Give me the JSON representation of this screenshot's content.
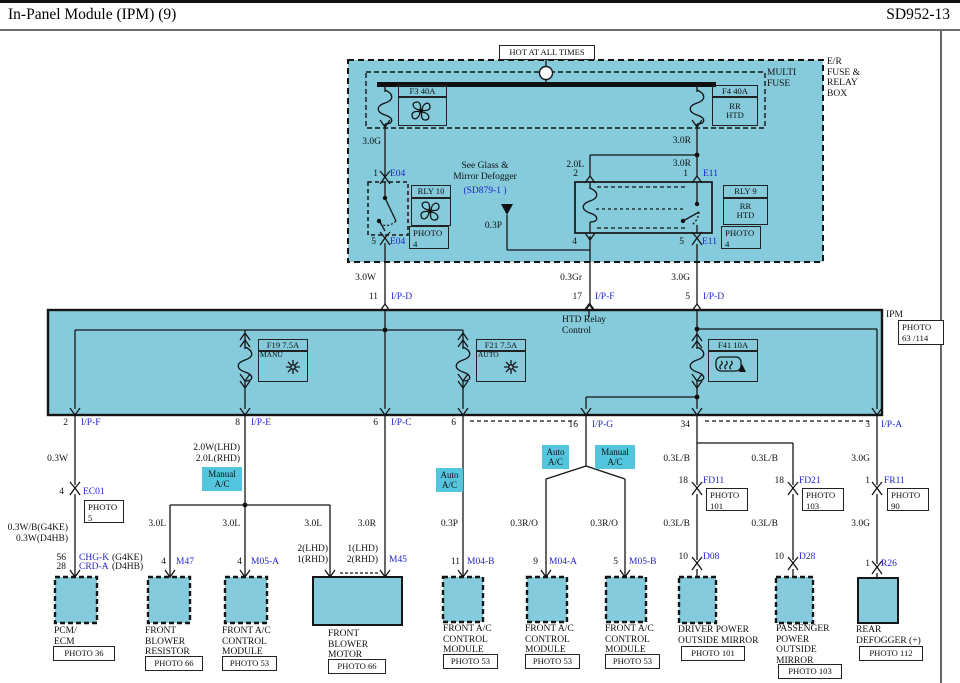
{
  "header": {
    "title": "In-Panel Module (IPM) (9)",
    "code": "SD952-13"
  },
  "colors": {
    "panel_fill": "#85cbdc",
    "highlight_fill": "#53c6de",
    "link_blue": "#1f1fd0"
  },
  "power": {
    "hot_label": "HOT AT ALL TIMES",
    "er_box_label": "E/R\nFUSE &\nRELAY\nBOX",
    "multi_fuse_label": "MULTI\nFUSE",
    "f3_label": "F3 40A",
    "f4_label": "F4 40A",
    "f4_sub": "RR\nHTD",
    "w_f3_out": "3.0G",
    "w_f4_out": "3.0R",
    "w_coil_in": "2.0L",
    "w_sw_in": "3.0R",
    "rly10": {
      "label": "RLY 10",
      "photo": "PHOTO\n4",
      "pin_top": "1",
      "conn_top": "E04",
      "pin_bot": "5",
      "conn_bot": "E04"
    },
    "rly9": {
      "label": "RLY 9",
      "sub": "RR\nHTD",
      "photo": "PHOTO\n4",
      "pin_coil_top": "2",
      "pin_coil_bot": "4",
      "pin_sw_top": "1",
      "conn_sw_top": "E11",
      "pin_sw_bot": "5",
      "conn_sw_bot": "E11"
    },
    "see_glass": "See Glass &\nMirror Defogger",
    "sd_ref": "(SD879-1 )",
    "w_defog_ctl": "0.3P",
    "w_out_left": "3.0W",
    "w_out_mid": "0.3Gr",
    "w_out_right": "3.0G"
  },
  "ipm": {
    "label": "IPM",
    "photo": "PHOTO\n63 /114",
    "htd_note": "HTD Relay\nControl",
    "f19_label": "F19 7.5A",
    "f19_sub": "MANU",
    "f21_label": "F21 7.5A",
    "f21_sub": "AUTO",
    "f41_label": "F41 10A",
    "pins_top": [
      {
        "num": "11",
        "name": "I/P-D"
      },
      {
        "num": "17",
        "name": "I/P-F"
      },
      {
        "num": "5",
        "name": "I/P-D"
      }
    ],
    "pins_bottom": [
      {
        "num": "2",
        "name": "I/P-F"
      },
      {
        "num": "8",
        "name": "I/P-E"
      },
      {
        "num": "6",
        "name": "I/P-C"
      },
      {
        "num": "6",
        "name": ""
      },
      {
        "num": "16",
        "name": "I/P-G"
      },
      {
        "num": "34",
        "name": ""
      },
      {
        "num": "3",
        "name": "I/P-A"
      }
    ]
  },
  "branches": {
    "pcm": {
      "w1": "0.3W",
      "pin": "4",
      "conn": "EC01",
      "photo": "PHOTO\n5",
      "w2": "0.3W/B(G4KE)\n0.3W(D4HB)",
      "pin1": "56",
      "name1": "CHG-K",
      "var1": "(G4KE)",
      "pin2": "28",
      "name2": "CRD-A",
      "var2": "(D4HB)"
    },
    "manual": {
      "w1": "2.0W(LHD)\n2.0L(RHD)",
      "tag": "Manual\nA/C",
      "w2": "3.0L",
      "w3": "3.0L",
      "w4": "3.0L",
      "pin_m47": "4",
      "conn_m47": "M47",
      "pin_m05a": "4",
      "conn_m05a": "M05-A",
      "motor_pin_l": "2(LHD)\n1(RHD)"
    },
    "motor": {
      "w1": "3.0R",
      "pin": "1(LHD)\n2(RHD)",
      "conn": "M45"
    },
    "auto": {
      "tag": "Auto\nA/C",
      "w1": "0.3P",
      "pin": "11",
      "conn": "M04-B"
    },
    "indicator": {
      "tag_l": "Auto\nA/C",
      "tag_r": "Manual\nA/C",
      "w_l": "0.3R/O",
      "w_r": "0.3R/O",
      "pin_l": "9",
      "conn_l": "M04-A",
      "pin_r": "5",
      "conn_r": "M05-B"
    },
    "mirror_l": {
      "w1": "0.3L/B",
      "pin1": "18",
      "conn1": "FD11",
      "photo1": "PHOTO\n101",
      "w2": "0.3L/B",
      "pin2": "10",
      "conn2": "D08"
    },
    "mirror_r": {
      "w1": "0.3L/B",
      "pin1": "18",
      "conn1": "FD21",
      "photo1": "PHOTO\n103",
      "w2": "0.3L/B",
      "pin2": "10",
      "conn2": "D28"
    },
    "defogger": {
      "w1": "3.0G",
      "pin1": "1",
      "conn1": "FR11",
      "photo1": "PHOTO\n90",
      "w2": "3.0G",
      "pin2": "1",
      "conn2": "R26"
    }
  },
  "components": [
    {
      "name": "PCM/\nECM",
      "photo": "PHOTO 36"
    },
    {
      "name": "FRONT\nBLOWER\nRESISTOR",
      "photo": "PHOTO 66"
    },
    {
      "name": "FRONT A/C\nCONTROL\nMODULE",
      "photo": "PHOTO 53"
    },
    {
      "name": "FRONT\nBLOWER\nMOTOR",
      "photo": "PHOTO 66"
    },
    {
      "name": "FRONT A/C\nCONTROL\nMODULE",
      "photo": "PHOTO 53"
    },
    {
      "name": "FRONT A/C\nCONTROL\nMODULE",
      "photo": "PHOTO 53"
    },
    {
      "name": "FRONT A/C\nCONTROL\nMODULE",
      "photo": "PHOTO 53"
    },
    {
      "name": "DRIVER POWER\nOUTSIDE MIRROR",
      "photo": "PHOTO 101"
    },
    {
      "name": "PASSENGER\nPOWER\nOUTSIDE\nMIRROR",
      "photo": "PHOTO 103"
    },
    {
      "name": "REAR\nDEFOGGER (+)",
      "photo": "PHOTO 112"
    }
  ]
}
